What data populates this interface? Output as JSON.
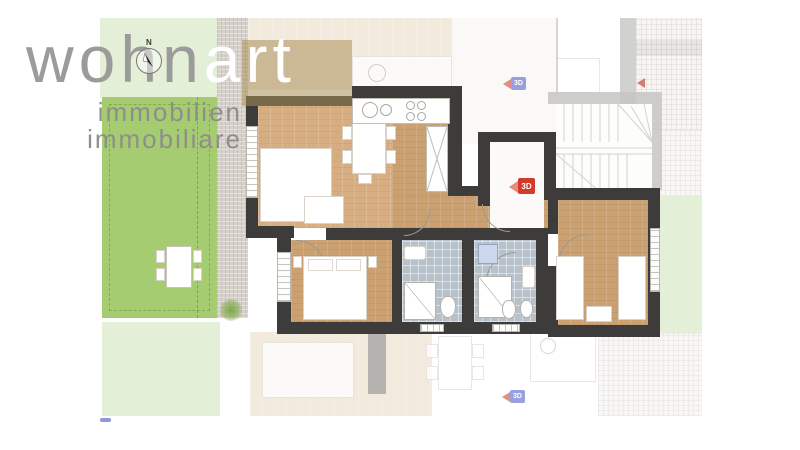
{
  "brand": {
    "name_part1": "wohn",
    "name_part2": "art",
    "subtitle_line1": "immobilien",
    "subtitle_line2": "immobiliare"
  },
  "compass": {
    "north_label": "N"
  },
  "badges": {
    "tour_main": "3D",
    "tour_upper": "3D",
    "tour_lower": "3D"
  },
  "colors": {
    "garden-green": "#a6cc72",
    "garden-pale": "#e4efd7",
    "gravel": "#cfc9c2",
    "wall-dark": "#3d3c3a",
    "wall-faded": "#c6c5c3",
    "wood": "#cba172",
    "wood-light": "#d6ae81",
    "wood-faded": "#ead9c4",
    "tile": "#b7c1ca",
    "badge-red": "#d43a2a",
    "badge-blue": "#8289d8",
    "logo-gray": "#9b9b99",
    "logo-tan": "#a89058"
  }
}
